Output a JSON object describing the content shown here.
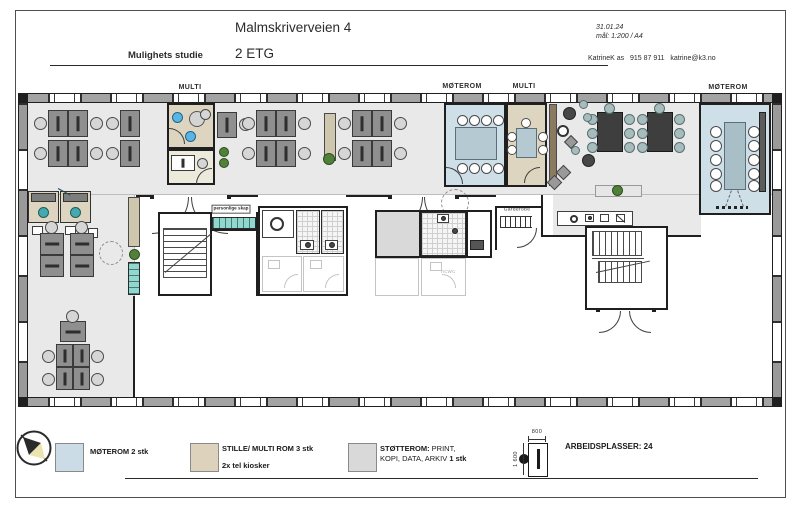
{
  "header": {
    "subtitle": "Mulighets studie",
    "title": "Malmskriverveien 4",
    "floor": "2 ETG",
    "date": "31.01.24",
    "scale": "mål: 1:200 / A4",
    "contact": "KatrineK as   915 87 911   katrine@k3.no"
  },
  "plan_labels": {
    "multi_left": "MULTI",
    "moterom_center": "MØTEROM",
    "multi_center": "MULTI",
    "moterom_right": "MØTEROM",
    "sosial_sone": "SOSIAL SONE/ SPISE",
    "tel_kiosk": "Tel kiosk",
    "personlige_skap": "personlige skap",
    "kopi_data": "KOPI\nDATA",
    "hcwc_upper": "hcwc",
    "bk": "bk",
    "garderobe": "Garderobe",
    "hcwc_lower": "hcwc"
  },
  "legend": {
    "moterom_label": "MØTEROM 2 stk",
    "stille_label": "STILLE/ MULTI ROM 3 stk",
    "stille_sublabel": "2x tel kiosker",
    "stotterom_bold": "STØTTEROM:",
    "stotterom_rest": " PRINT,",
    "stotterom_line2": "KOPI, DATA, ARKIV ",
    "stotterom_line2_bold": "1 stk",
    "arbeidsplasser": "ARBEIDSPLASSER: 24",
    "desk_width": "800",
    "desk_depth": "1 600"
  },
  "legend_colors": {
    "moterom": "#ccdce6",
    "stille": "#ddd3bc",
    "stotterom": "#d9d9d9"
  }
}
